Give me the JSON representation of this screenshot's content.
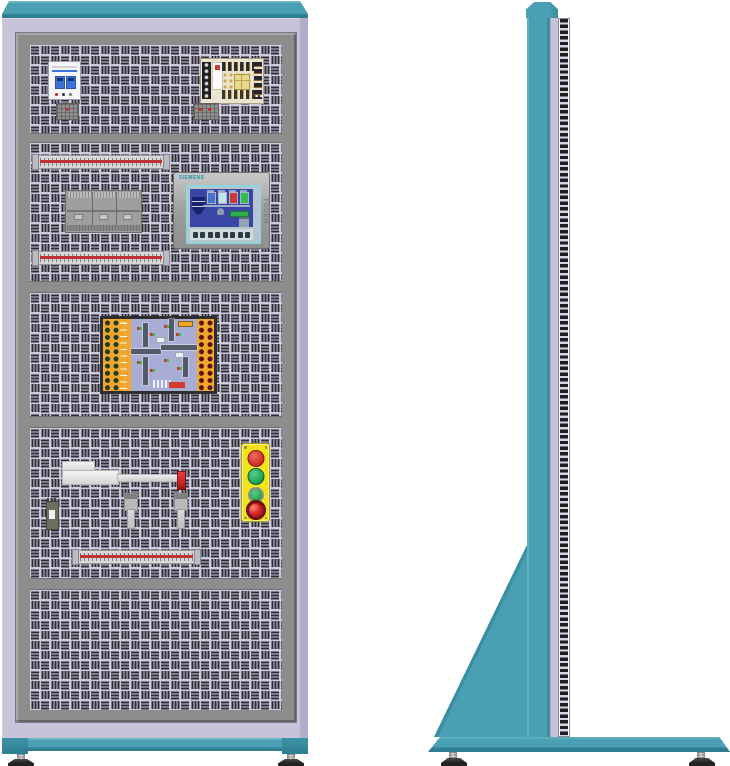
{
  "scene": {
    "title": "Electrical automation training cabinet",
    "views": {
      "left": "front view",
      "right": "side view"
    }
  },
  "hmi": {
    "brand": "SIEMENS",
    "touch_label": "TOUCH"
  },
  "front_view": {
    "panels": [
      {
        "row": 1,
        "components": [
          "circuit-breaker",
          "switching-power-supply",
          "terminal-block",
          "terminal-block"
        ]
      },
      {
        "row": 2,
        "components": [
          "wiring-terminal-strip",
          "plc-module",
          "hmi-touch-panel",
          "wiring-terminal-strip"
        ]
      },
      {
        "row": 3,
        "components": [
          "traffic-light-simulation-board"
        ]
      },
      {
        "row": 4,
        "components": [
          "pneumatic-cylinder",
          "relay",
          "sensor",
          "sensor",
          "pushbutton-station",
          "wiring-terminal-strip"
        ]
      },
      {
        "row": 5,
        "components": []
      }
    ]
  },
  "side_view": {
    "components": [
      "top-cap",
      "column",
      "slotted-mounting-rail",
      "support-gusset",
      "base",
      "leveling-feet"
    ]
  },
  "colors": {
    "teal": "#4aa0b2",
    "teal_light": "#68b6c4",
    "teal_dark": "#2e7d91",
    "lavender": "#c7c4da",
    "lavender_shade": "#b1aecb",
    "frame": "#8d8d8d",
    "panel_bg": "#cdc9df",
    "slot": "#2c2c32",
    "strip_red": "#c03232",
    "station_yellow": "#f1e41c",
    "btn_red": "#d33028",
    "btn_green": "#1da355",
    "estop_red": "#d42222",
    "board_orange": "#f3a62d",
    "board_pcb": "#a8add5",
    "road": "#555a68",
    "label_red": "#d23b2e",
    "screen_blue": "#3946a6",
    "tank_navy": "#17246d",
    "cyan": "#8fd6de",
    "conveyor": "#2db04a",
    "psu_board": "#eae3cf",
    "psu_red": "#cf3a2e",
    "transformer": "#e7d88b",
    "breaker_blue": "#3a72d8",
    "tip_red": "#cf2626",
    "rail_bg": "#d7d3e5",
    "rail_slot": "#1e1e1e",
    "foot": "#222222"
  }
}
